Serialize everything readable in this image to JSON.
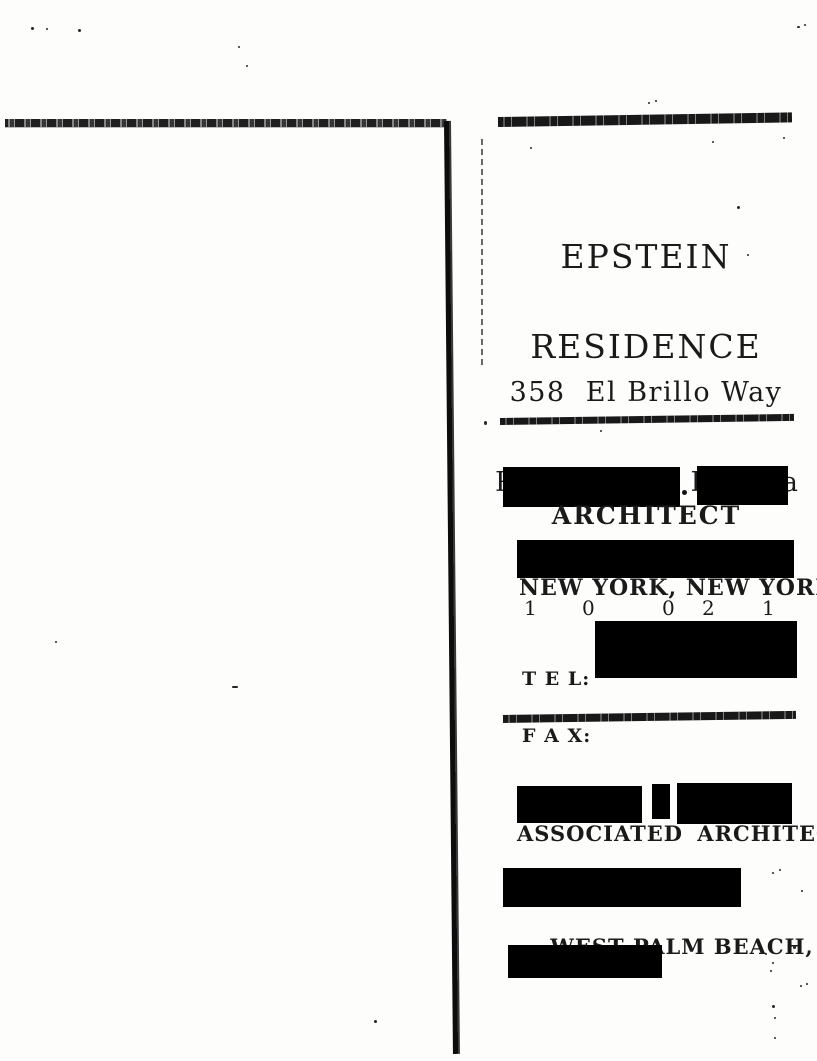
{
  "title": {
    "line1": "EPSTEIN",
    "line2": "RESIDENCE"
  },
  "address": {
    "line1": "358  El Brillo Way",
    "line2": "Palm Beach, Florida"
  },
  "architect": {
    "heading": "ARCHITECT",
    "city": "NEW YORK, NEW YORK",
    "zip_digits": [
      "1",
      "0",
      "0",
      "2",
      "1"
    ],
    "tel_label": "T E L:",
    "fax_label": "F A X:"
  },
  "associated_architect": {
    "heading": "ASSOCIATED ARCHITECT",
    "city": "WEST PALM BEACH,",
    "state": "FLA."
  },
  "colors": {
    "ink": "#1a1a1a",
    "redaction": "#000000",
    "paper": "#fdfdfc"
  }
}
